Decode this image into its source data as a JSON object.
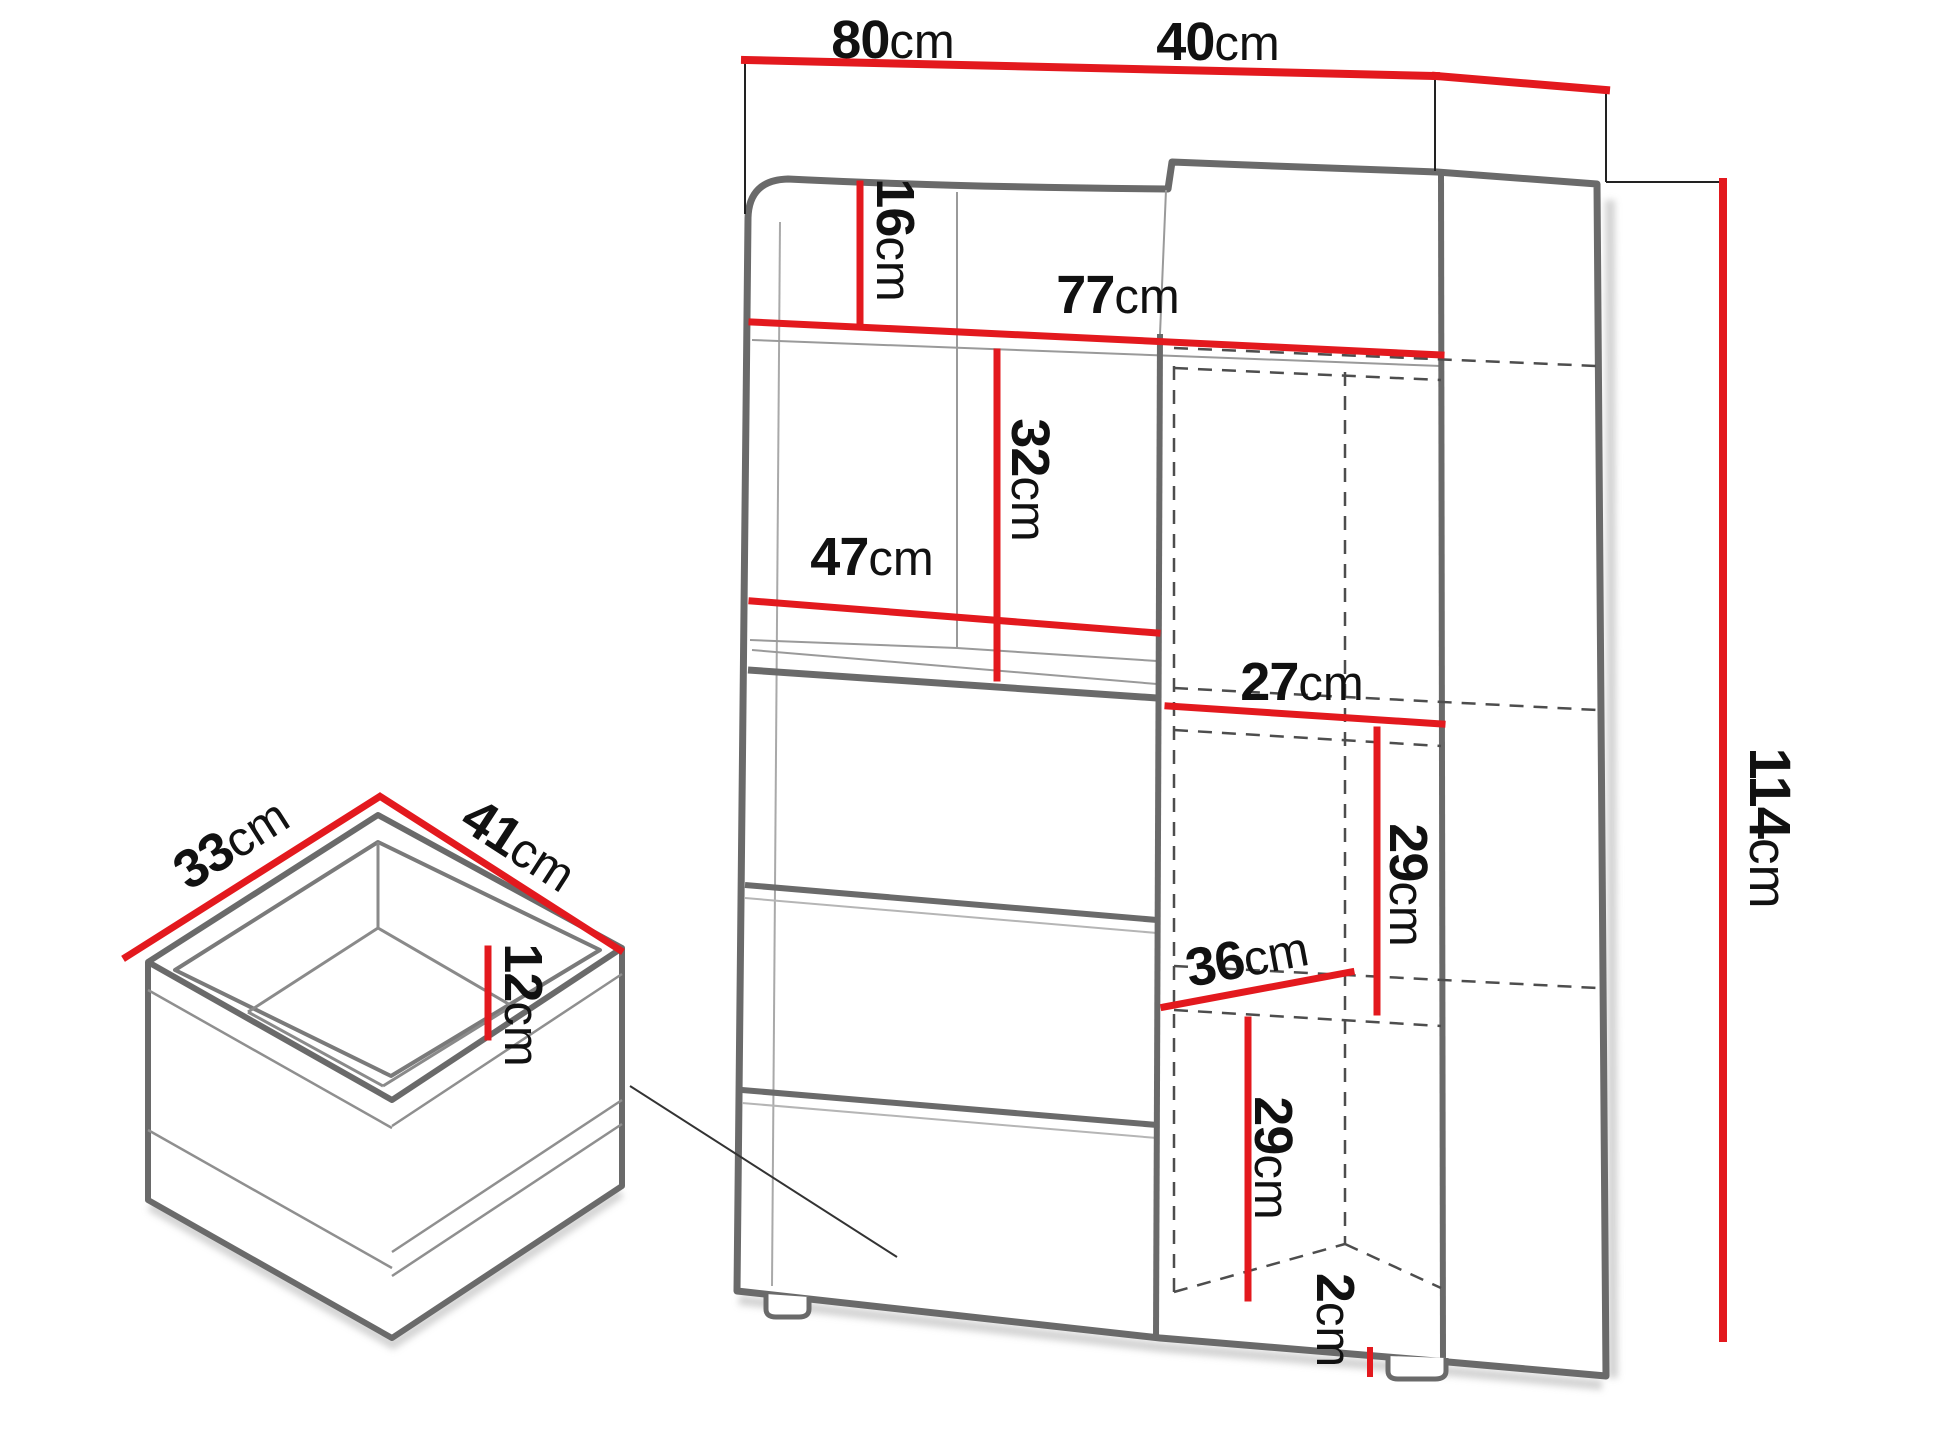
{
  "diagram": {
    "title": "cabinet-dimension-drawing",
    "unit": "cm",
    "colors": {
      "dimension_line": "#e3191e",
      "outline_gray": "#6a6a6a",
      "text": "#111111",
      "hidden_edge": "#4d4d4d"
    },
    "cabinet": {
      "width": {
        "value": "80",
        "unit": "cm"
      },
      "depth": {
        "value": "40",
        "unit": "cm"
      },
      "height": {
        "value": "114",
        "unit": "cm"
      },
      "top_niche_height": {
        "value": "16",
        "unit": "cm"
      },
      "interior_width": {
        "value": "77",
        "unit": "cm"
      },
      "niche_height": {
        "value": "32",
        "unit": "cm"
      },
      "niche_width": {
        "value": "47",
        "unit": "cm"
      },
      "right_shelf_width": {
        "value": "27",
        "unit": "cm"
      },
      "right_shelf_upper_height": {
        "value": "29",
        "unit": "cm"
      },
      "right_shelf_depth": {
        "value": "36",
        "unit": "cm"
      },
      "right_shelf_lower_height": {
        "value": "29",
        "unit": "cm"
      },
      "foot_height": {
        "value": "2",
        "unit": "cm"
      }
    },
    "drawer": {
      "width": {
        "value": "33",
        "unit": "cm"
      },
      "depth": {
        "value": "41",
        "unit": "cm"
      },
      "inner_height": {
        "value": "12",
        "unit": "cm"
      }
    }
  }
}
